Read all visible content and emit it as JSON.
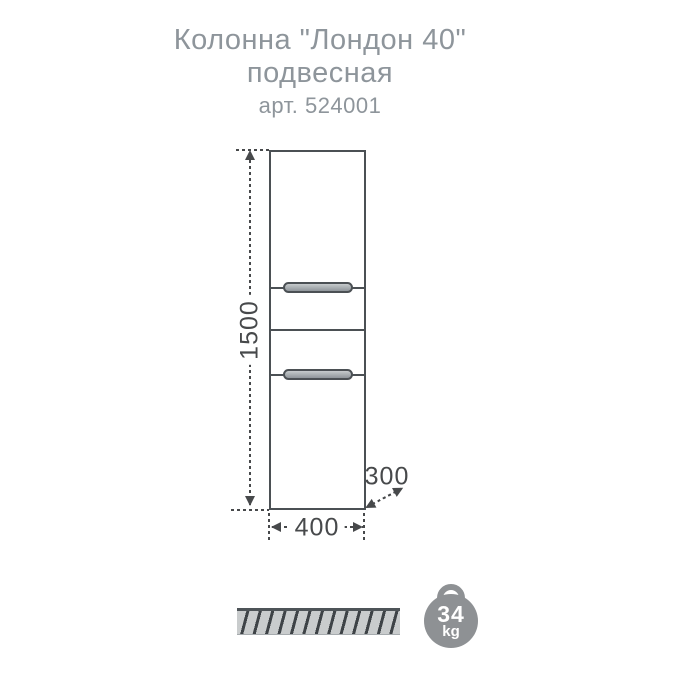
{
  "title": {
    "line1": "Колонна \"Лондон 40\"",
    "line2": "подвесная",
    "article": "арт. 524001"
  },
  "drawing": {
    "height_label": "1500",
    "width_label": "400",
    "depth_label": "300"
  },
  "weight": {
    "value": "34",
    "unit": "kg"
  },
  "colors": {
    "title_text": "#8e959b",
    "line": "#4b5054",
    "dim": "#47494b",
    "hatch_fill": "#c9cccd",
    "hatch_stroke": "#3e4347",
    "weight_badge": "#8e9194"
  }
}
